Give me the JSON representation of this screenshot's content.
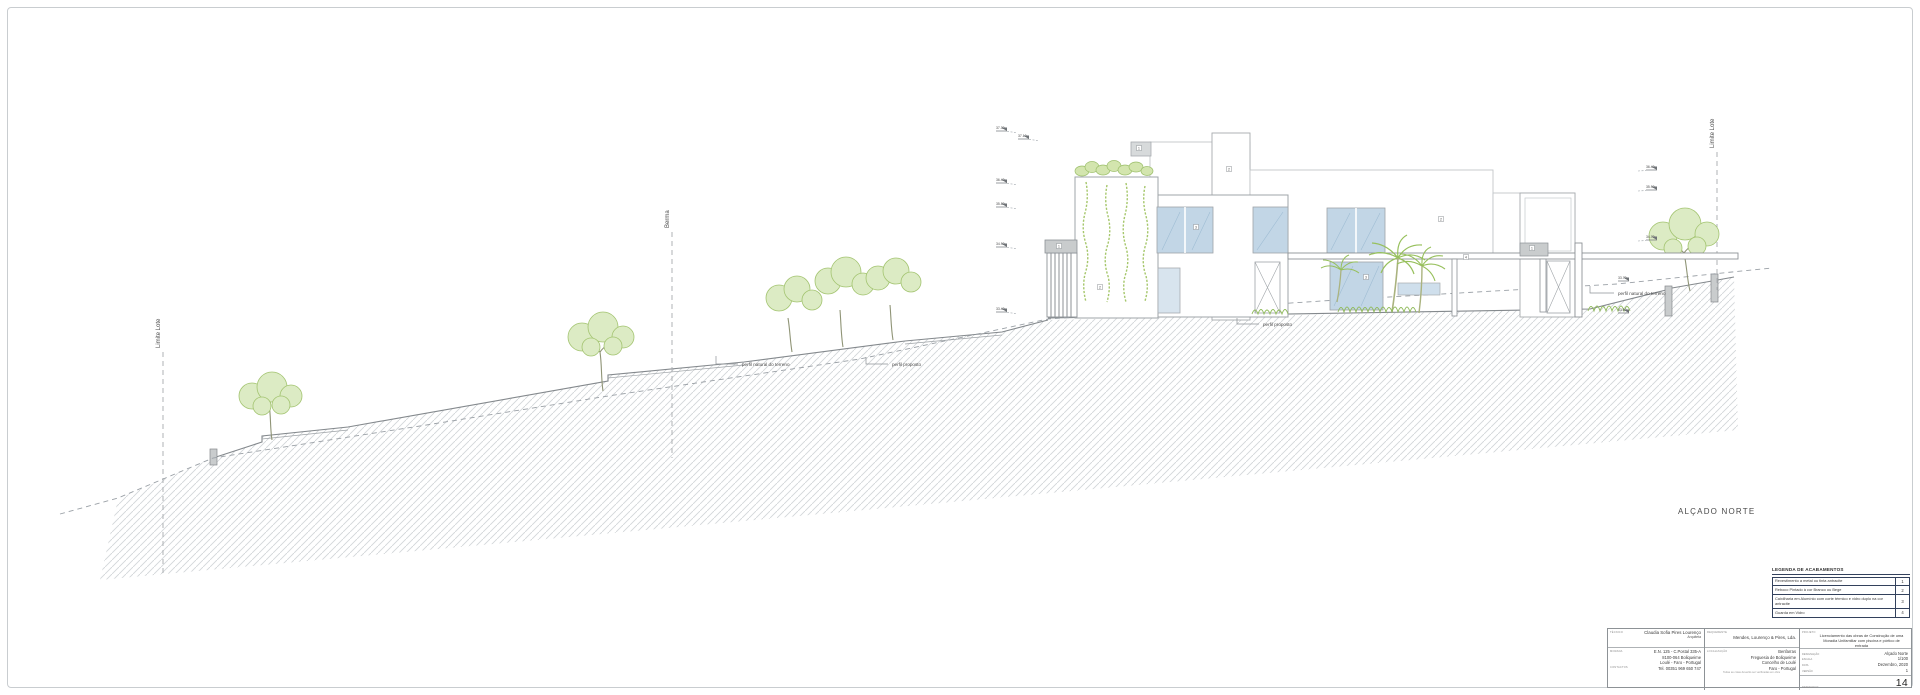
{
  "drawing_title": "ALÇADO NORTE",
  "reference_lines": {
    "limite_lote_left": "Limite Lote",
    "berma": "Berma",
    "limite_lote_right": "Limite Lote"
  },
  "profile_labels": {
    "natural_left": "perfil natural do terreno",
    "proposto_left": "perfil proposto",
    "proposto_center": "perfil proposto",
    "natural_right": "perfil natural do terreno"
  },
  "elevation_markers": {
    "left": [
      "37.30",
      "37.10",
      "36.40",
      "35.80",
      "34.90",
      "33.40"
    ],
    "right": [
      "36.40",
      "35.90",
      "34.70",
      "33.70",
      "33.10"
    ]
  },
  "keynotes": [
    "1",
    "2",
    "1",
    "2",
    "3",
    "2",
    "4",
    "1",
    "3"
  ],
  "legend": {
    "title": "LEGENDA DE ACABAMENTOS",
    "rows": [
      {
        "text": "Revestimento a metal ou tinta antracite",
        "num": "1"
      },
      {
        "text": "Reboco Pintado à cor Branco ou Bege",
        "num": "2"
      },
      {
        "text": "Caixilharia em Alumínio com corte térmico e vidro duplo na cor antracite",
        "num": "3"
      },
      {
        "text": "Guarda em Vidro",
        "num": "4"
      }
    ]
  },
  "title_block": {
    "architect": {
      "label": "técnico",
      "name": "Claudia Sofia Pires Lourenço",
      "role": "Arquiteta",
      "address_label": "morada",
      "address": [
        "E.N. 125 - C.Postal 335-A",
        "8100-064 Boliqueime",
        "Loulé - Faro - Portugal"
      ],
      "contact_label": "contactos",
      "phone": "Tel. 00351 969 650 747"
    },
    "client": {
      "label": "requerente",
      "name": "Mendes, Lourenço & Pires, Lda.",
      "location_label": "localização",
      "location": [
        "Benfarras",
        "Freguesia de Boliqueime",
        "Concelho de Loulé",
        "Faro - Portugal"
      ],
      "note": "Todas as cotas deverão ser verificadas em obra"
    },
    "project": {
      "label": "projeto",
      "description": "Licenciamento das obras de Construção de uma Moradia Unifamiliar com piscina e pórtico de entrada",
      "fields": [
        {
          "label": "designação",
          "value": "Alçado Norte"
        },
        {
          "label": "escala",
          "value": "1/100"
        },
        {
          "label": "data",
          "value": "Dezembro, 2020"
        },
        {
          "label": "versão",
          "value": "1"
        }
      ],
      "sheet_label": "desenho nº",
      "sheet_number": "14"
    }
  },
  "colors": {
    "line": "#85898d",
    "light_line": "#b4b8bb",
    "hatch": "#d3d6d8",
    "glass": "#c2d6e6",
    "glass_line": "#9fbdd4",
    "green": "#a3c470",
    "green_fill": "#dcebc4",
    "gray_fill": "#c9cccd",
    "legend_border": "#33415c"
  }
}
